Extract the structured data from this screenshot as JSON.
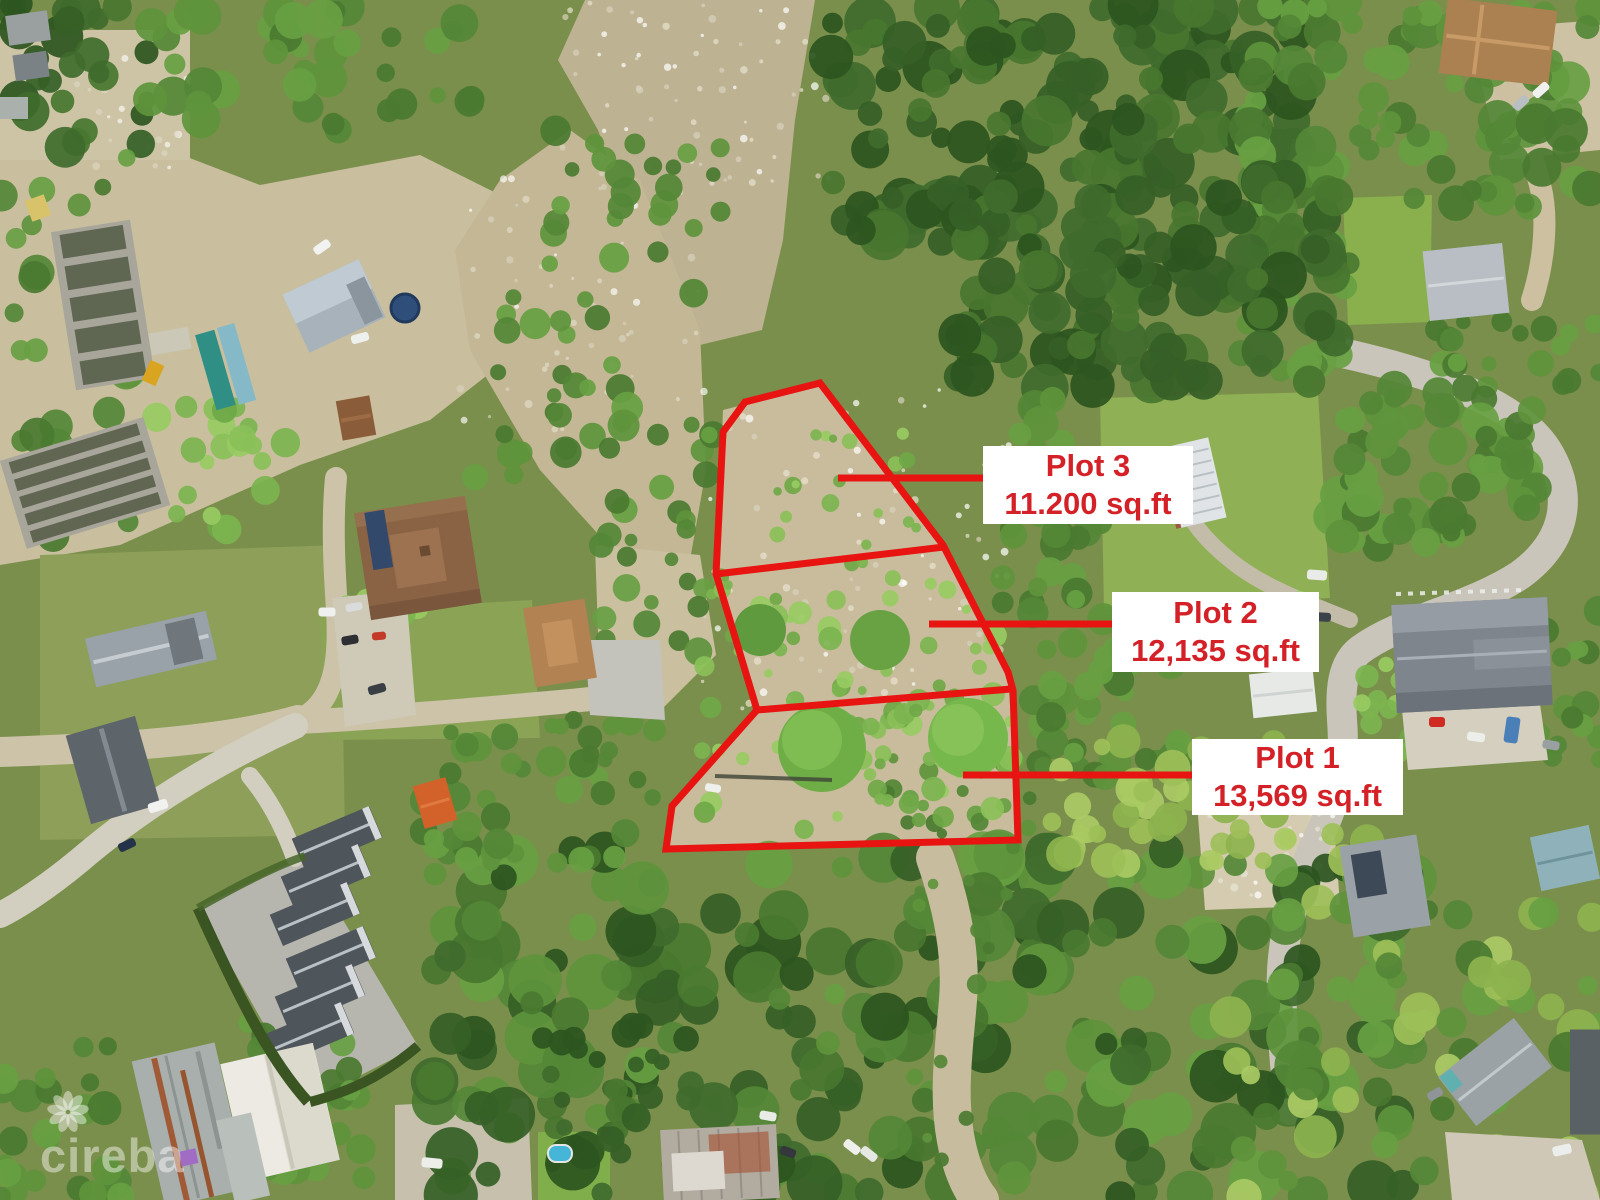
{
  "plots": [
    {
      "name": "Plot 3",
      "area": "11.200 sq.ft"
    },
    {
      "name": "Plot 2",
      "area": "12,135 sq.ft"
    },
    {
      "name": "Plot 1",
      "area": "13,569 sq.ft"
    }
  ],
  "watermark": {
    "text": "cireba",
    "icon": "flower-rosette-icon"
  },
  "theme": {
    "plot-line": "#e81412",
    "label-bg": "#ffffff",
    "label-text": "#d42127",
    "watermark": "rgba(255,255,255,0.45)"
  }
}
